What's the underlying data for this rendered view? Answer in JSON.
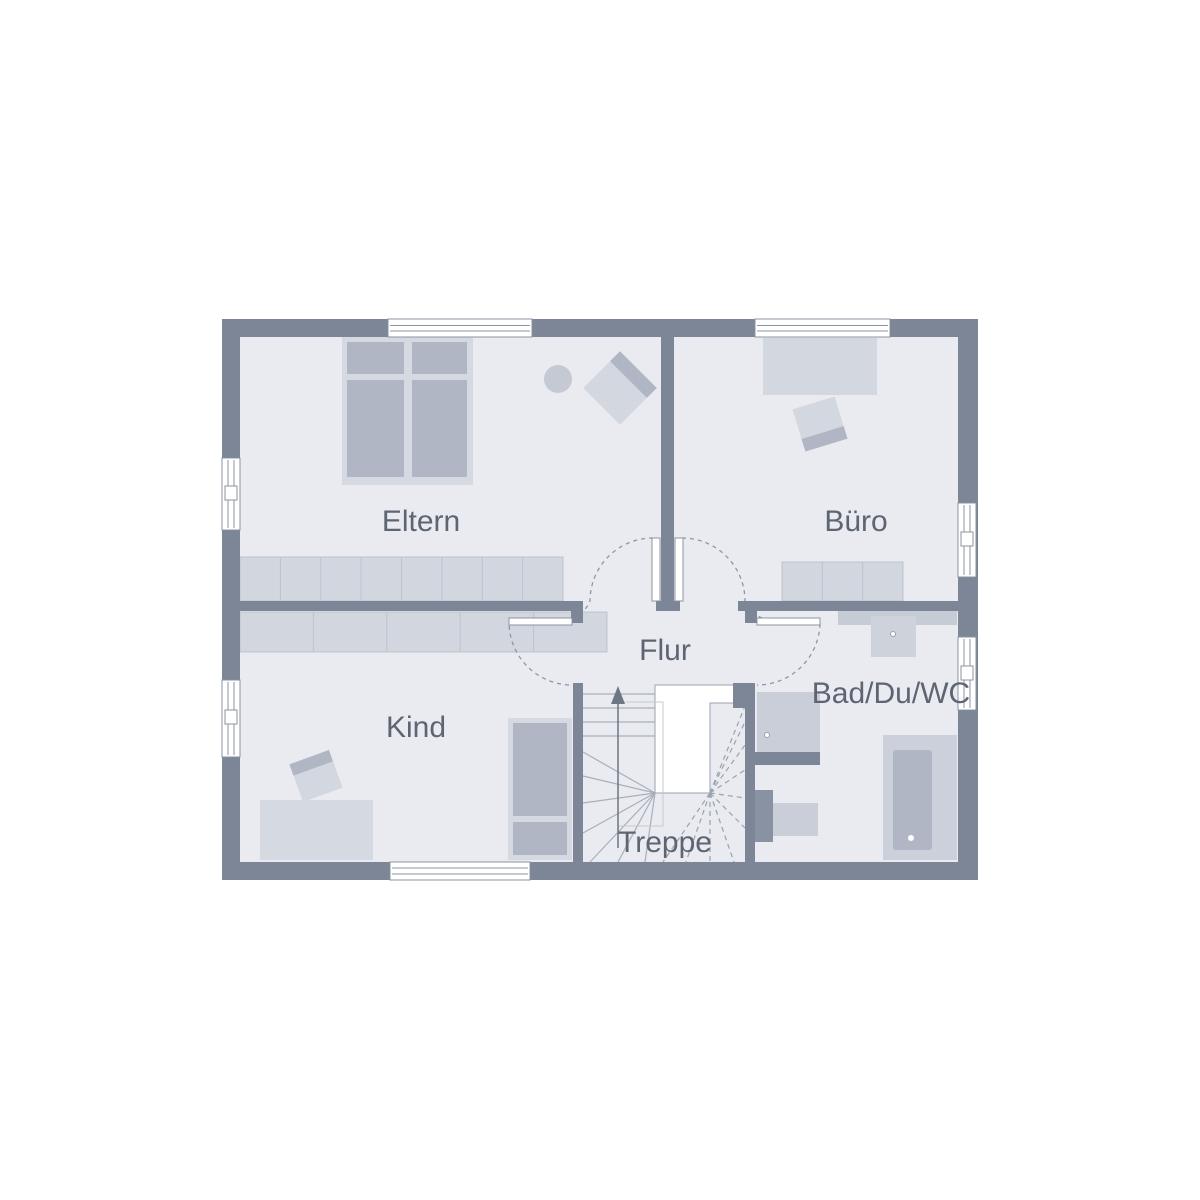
{
  "page": {
    "type": "floor-plan",
    "background": "#ffffff"
  },
  "plan": {
    "rooms": [
      {
        "key": "eltern",
        "label": "Eltern"
      },
      {
        "key": "buero",
        "label": "Büro"
      },
      {
        "key": "flur",
        "label": "Flur"
      },
      {
        "key": "kind",
        "label": "Kind"
      },
      {
        "key": "treppe",
        "label": "Treppe"
      },
      {
        "key": "bad",
        "label": "Bad/Du/WC"
      }
    ],
    "colors": {
      "wall": "#7d8696",
      "floor": "#e9ebf0",
      "furniture_light": "#d5d9e2",
      "furniture_shade": "#b0b6c3",
      "cabinet": "#d2d6df",
      "fixture": "#c9ced8",
      "counter": "#c6ccd6",
      "wc_tank": "#8992a2",
      "window": "#ffffff",
      "symbol_line": "#8b93a1",
      "label_text": "#5d6472"
    }
  }
}
